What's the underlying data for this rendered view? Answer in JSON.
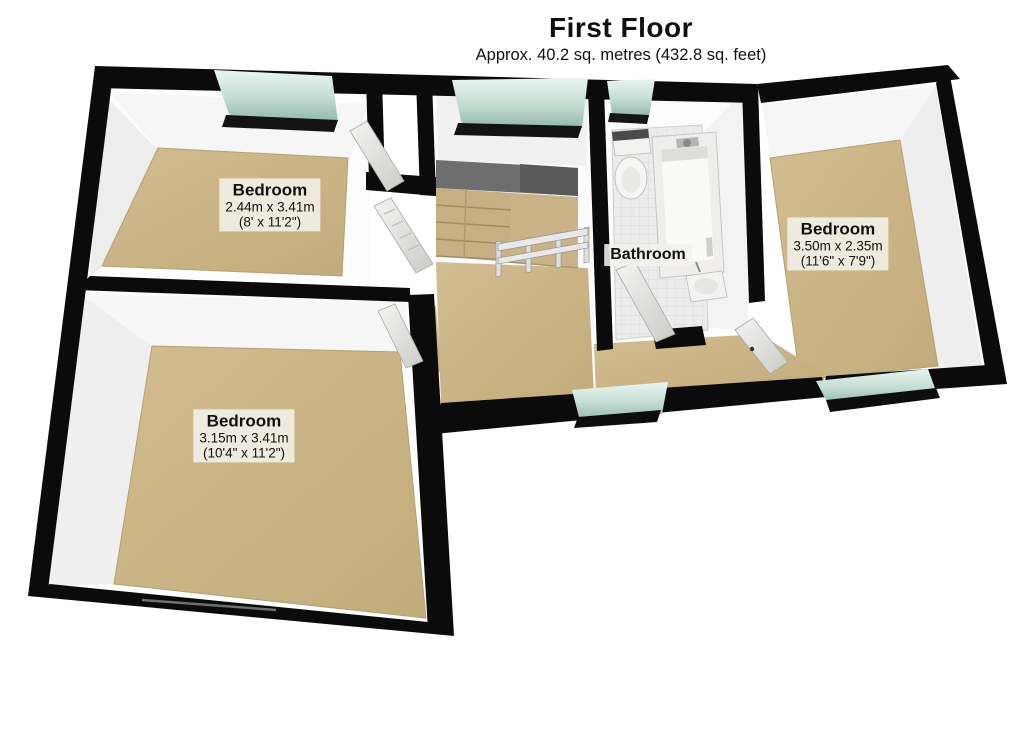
{
  "header": {
    "title": "First Floor",
    "subtitle": "Approx. 40.2 sq. metres (432.8 sq. feet)"
  },
  "rooms": {
    "bedroom1": {
      "name": "Bedroom",
      "metric": "2.44m x 3.41m",
      "imperial": "(8' x 11'2\")"
    },
    "bedroom2": {
      "name": "Bedroom",
      "metric": "3.50m x 2.35m",
      "imperial": "(11'6\" x 7'9\")"
    },
    "bedroom3": {
      "name": "Bedroom",
      "metric": "3.15m x 3.41m",
      "imperial": "(10'4\" x 11'2\")"
    },
    "bathroom": {
      "name": "Bathroom"
    }
  },
  "colors": {
    "wall": "#0b0b0b",
    "floor_carpet": "#c9b184",
    "floor_carpet_light": "#d4c094",
    "floor_tile": "#ececec",
    "window_glass": "#b9d4ca",
    "stair_wall": "#6e6e6e",
    "label_bg": "rgba(243,241,235,0.88)",
    "label_text": "#111111"
  }
}
